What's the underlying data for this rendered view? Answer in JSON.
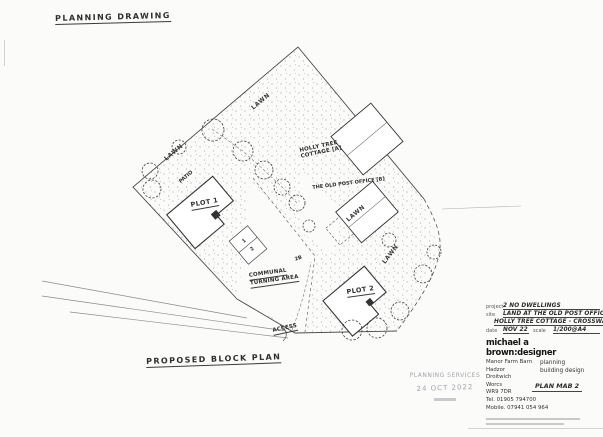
{
  "sheet": {
    "header_note": "PLANNING DRAWING",
    "caption": "PROPOSED BLOCK PLAN"
  },
  "plan": {
    "labels": {
      "plot1": "PLOT 1",
      "plot2": "PLOT 2",
      "holly_tree_line1": "HOLLY TREE",
      "holly_tree_line2": "COTTAGE [A]",
      "old_post_office": "THE OLD POST OFFICE [B]",
      "communal_line1": "COMMUNAL",
      "communal_line2": "TURNING AREA",
      "access": "ACCESS",
      "lawn": "LAWN",
      "patio": "PATIO",
      "space_1": "1",
      "space_2": "2",
      "space_2b": "2B"
    }
  },
  "stamp": {
    "line1": "PLANNING SERVICES",
    "date": "24 OCT 2022"
  },
  "titleblock": {
    "project_label": "project",
    "project_value": "2 NO DWELLINGS",
    "site_label": "site",
    "site_value1": "LAND AT THE OLD POST OFFICE/",
    "site_value2": "HOLLY TREE COTTAGE - CROSSWAY GRN",
    "date_label": "date",
    "date_value": "NOV 22",
    "scale_label": "scale",
    "scale_value": "1/200@A4",
    "designer": "michael a brown:designer",
    "address": [
      "Manor Farm Barn",
      "Hadzor",
      "Droitwich",
      "Worcs",
      "WR9 7DR",
      "Tel. 01905 794700",
      "Mobile. 07941 054 964"
    ],
    "services": [
      "planning",
      "building design"
    ],
    "plan_ref": "PLAN MAB 2"
  },
  "colors": {
    "paper": "#fbfbfa",
    "ink": "#2b2b2b",
    "pencil": "#888888",
    "stamp": "#a3a3ab"
  }
}
